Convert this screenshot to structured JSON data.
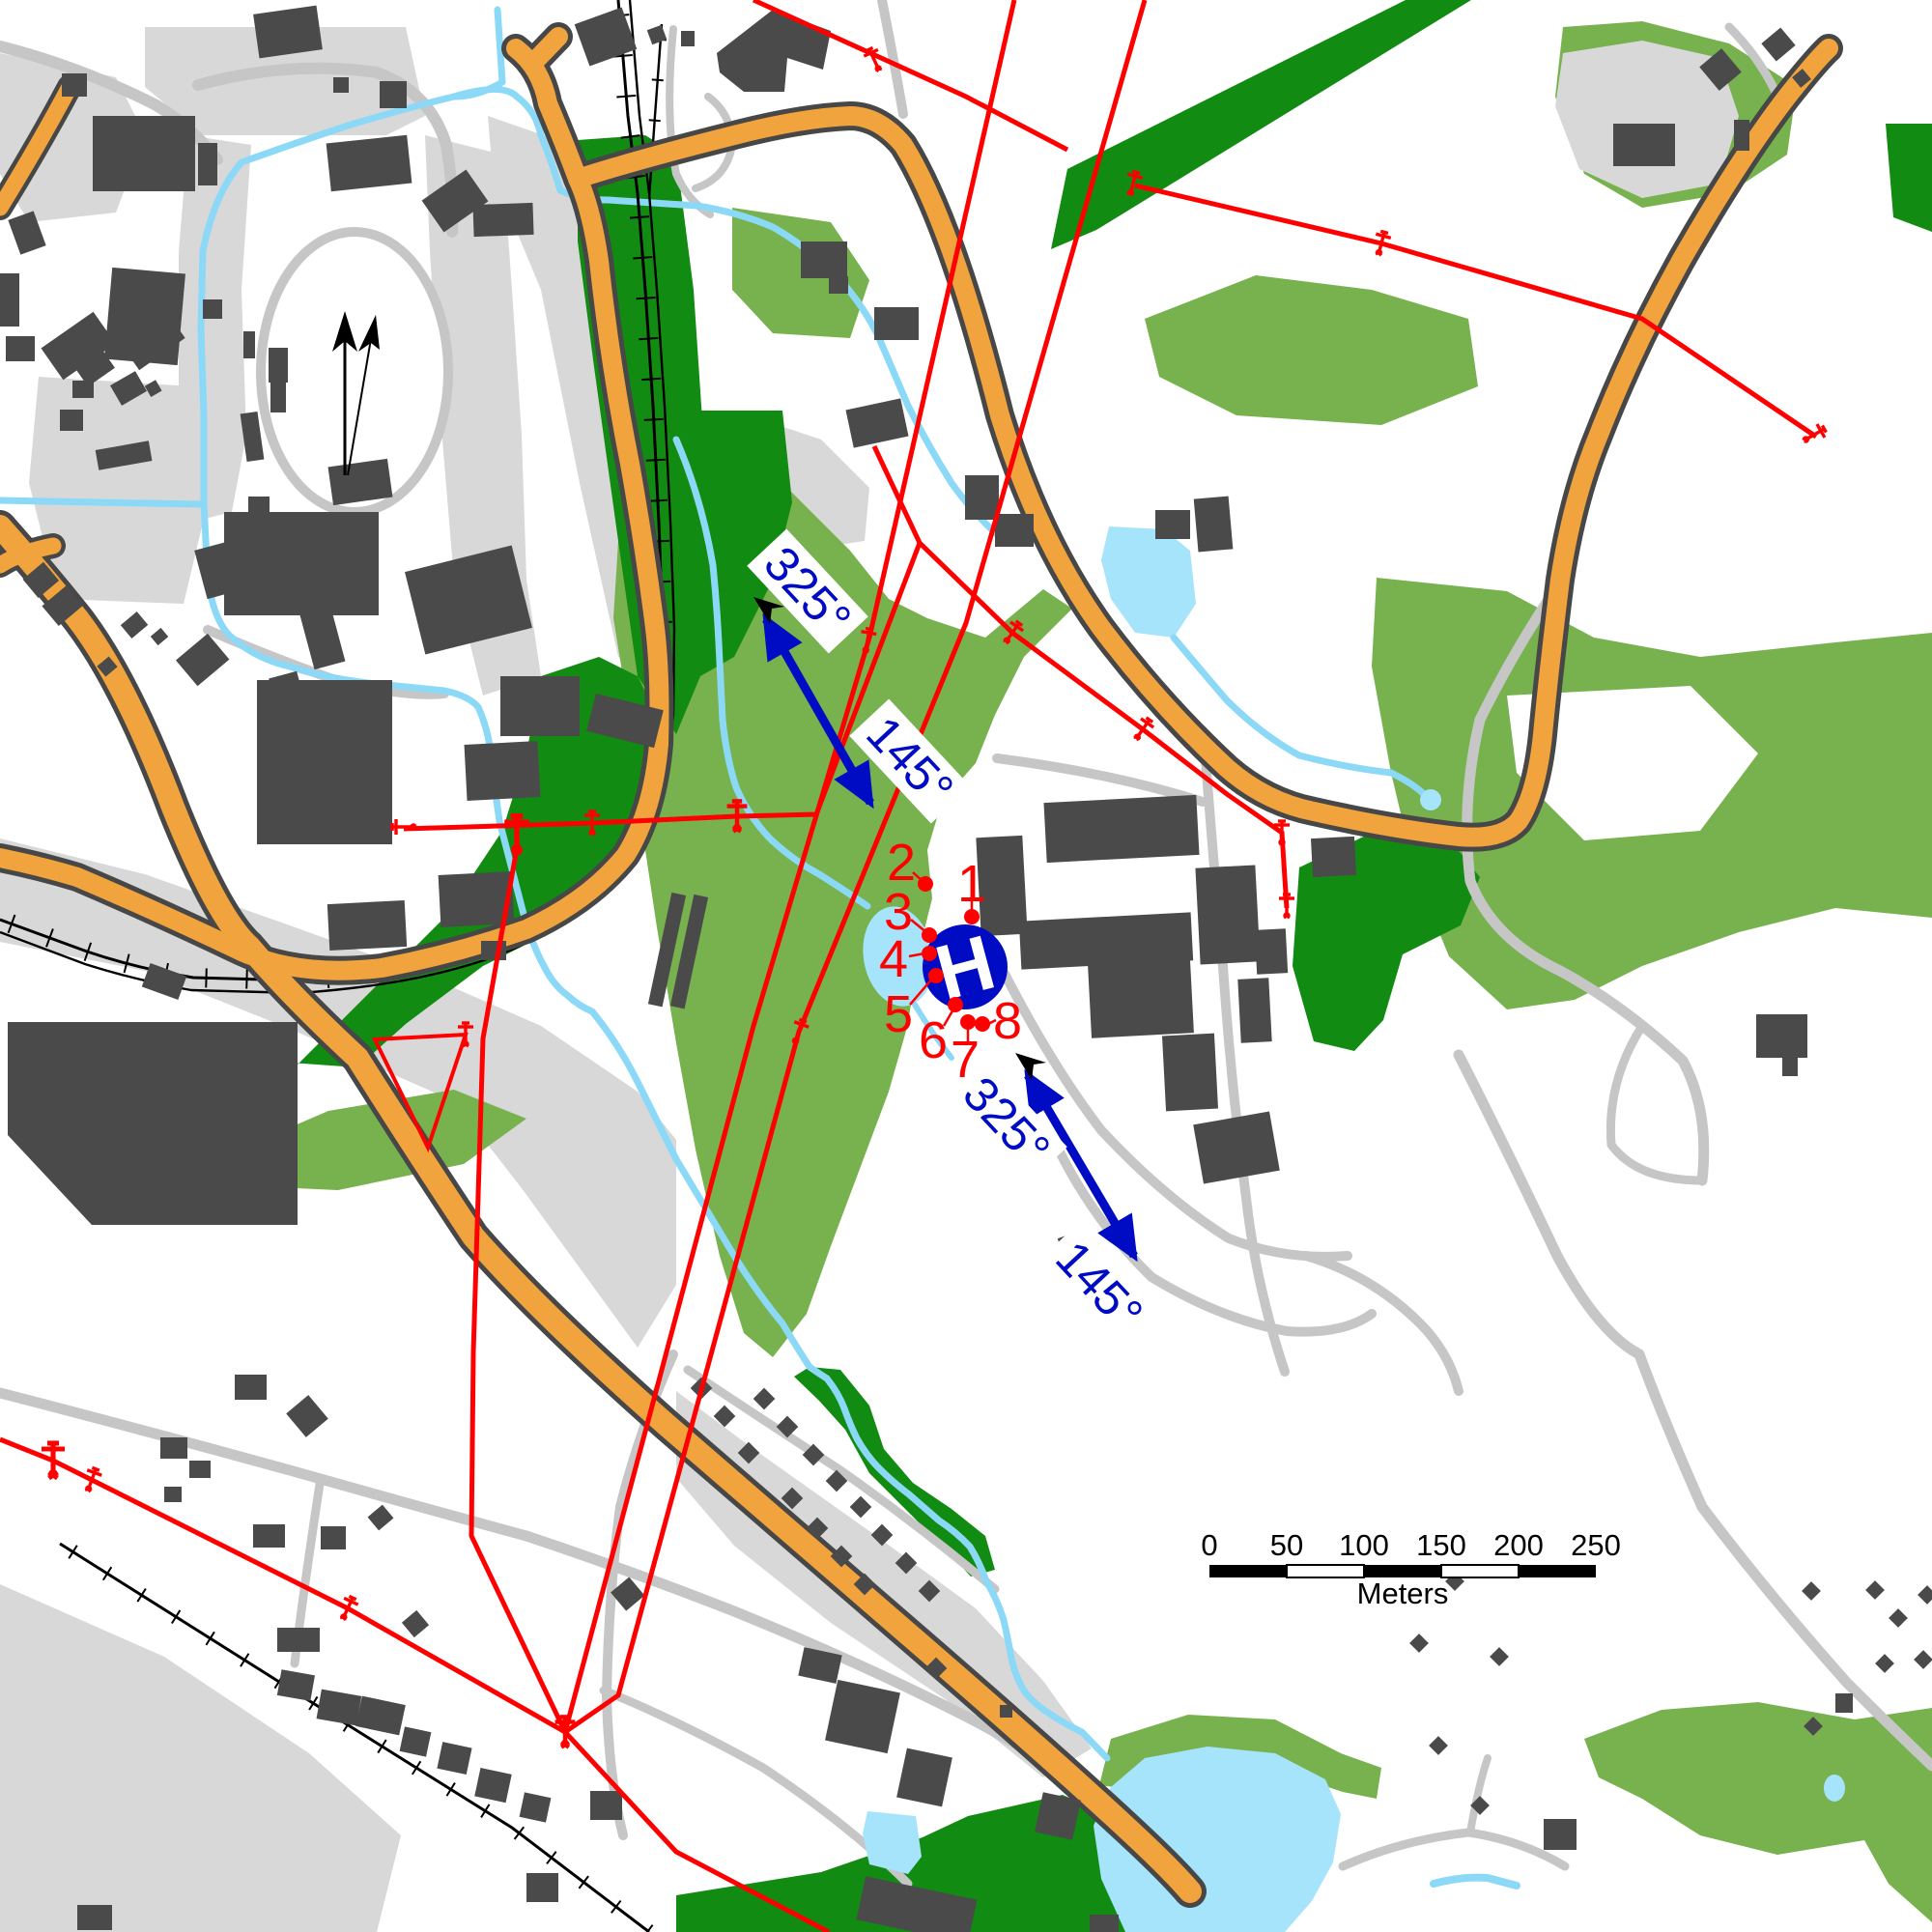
{
  "map": {
    "title": "helipad-approach-map",
    "helipad": {
      "symbol": "H"
    },
    "survey_points": [
      {
        "label": "1"
      },
      {
        "label": "2"
      },
      {
        "label": "3"
      },
      {
        "label": "4"
      },
      {
        "label": "5"
      },
      {
        "label": "6"
      },
      {
        "label": "7"
      },
      {
        "label": "8"
      }
    ],
    "bearing_arrows": [
      {
        "labels": [
          "325°",
          "145°"
        ]
      },
      {
        "labels": [
          "325°",
          "145°"
        ]
      }
    ],
    "scale_bar": {
      "ticks": [
        "0",
        "50",
        "100",
        "150",
        "200",
        "250"
      ],
      "unit_label": "Meters"
    },
    "colors": {
      "road_major": "#f1a33e",
      "road_minor": "#c6c6c6",
      "forest_dark": "#128b12",
      "vegetation_light": "#77b24e",
      "water": "#8cd9f7",
      "building": "#4a4a4a",
      "power_line": "#ff0000",
      "bearing_blue": "#000bc4"
    }
  }
}
